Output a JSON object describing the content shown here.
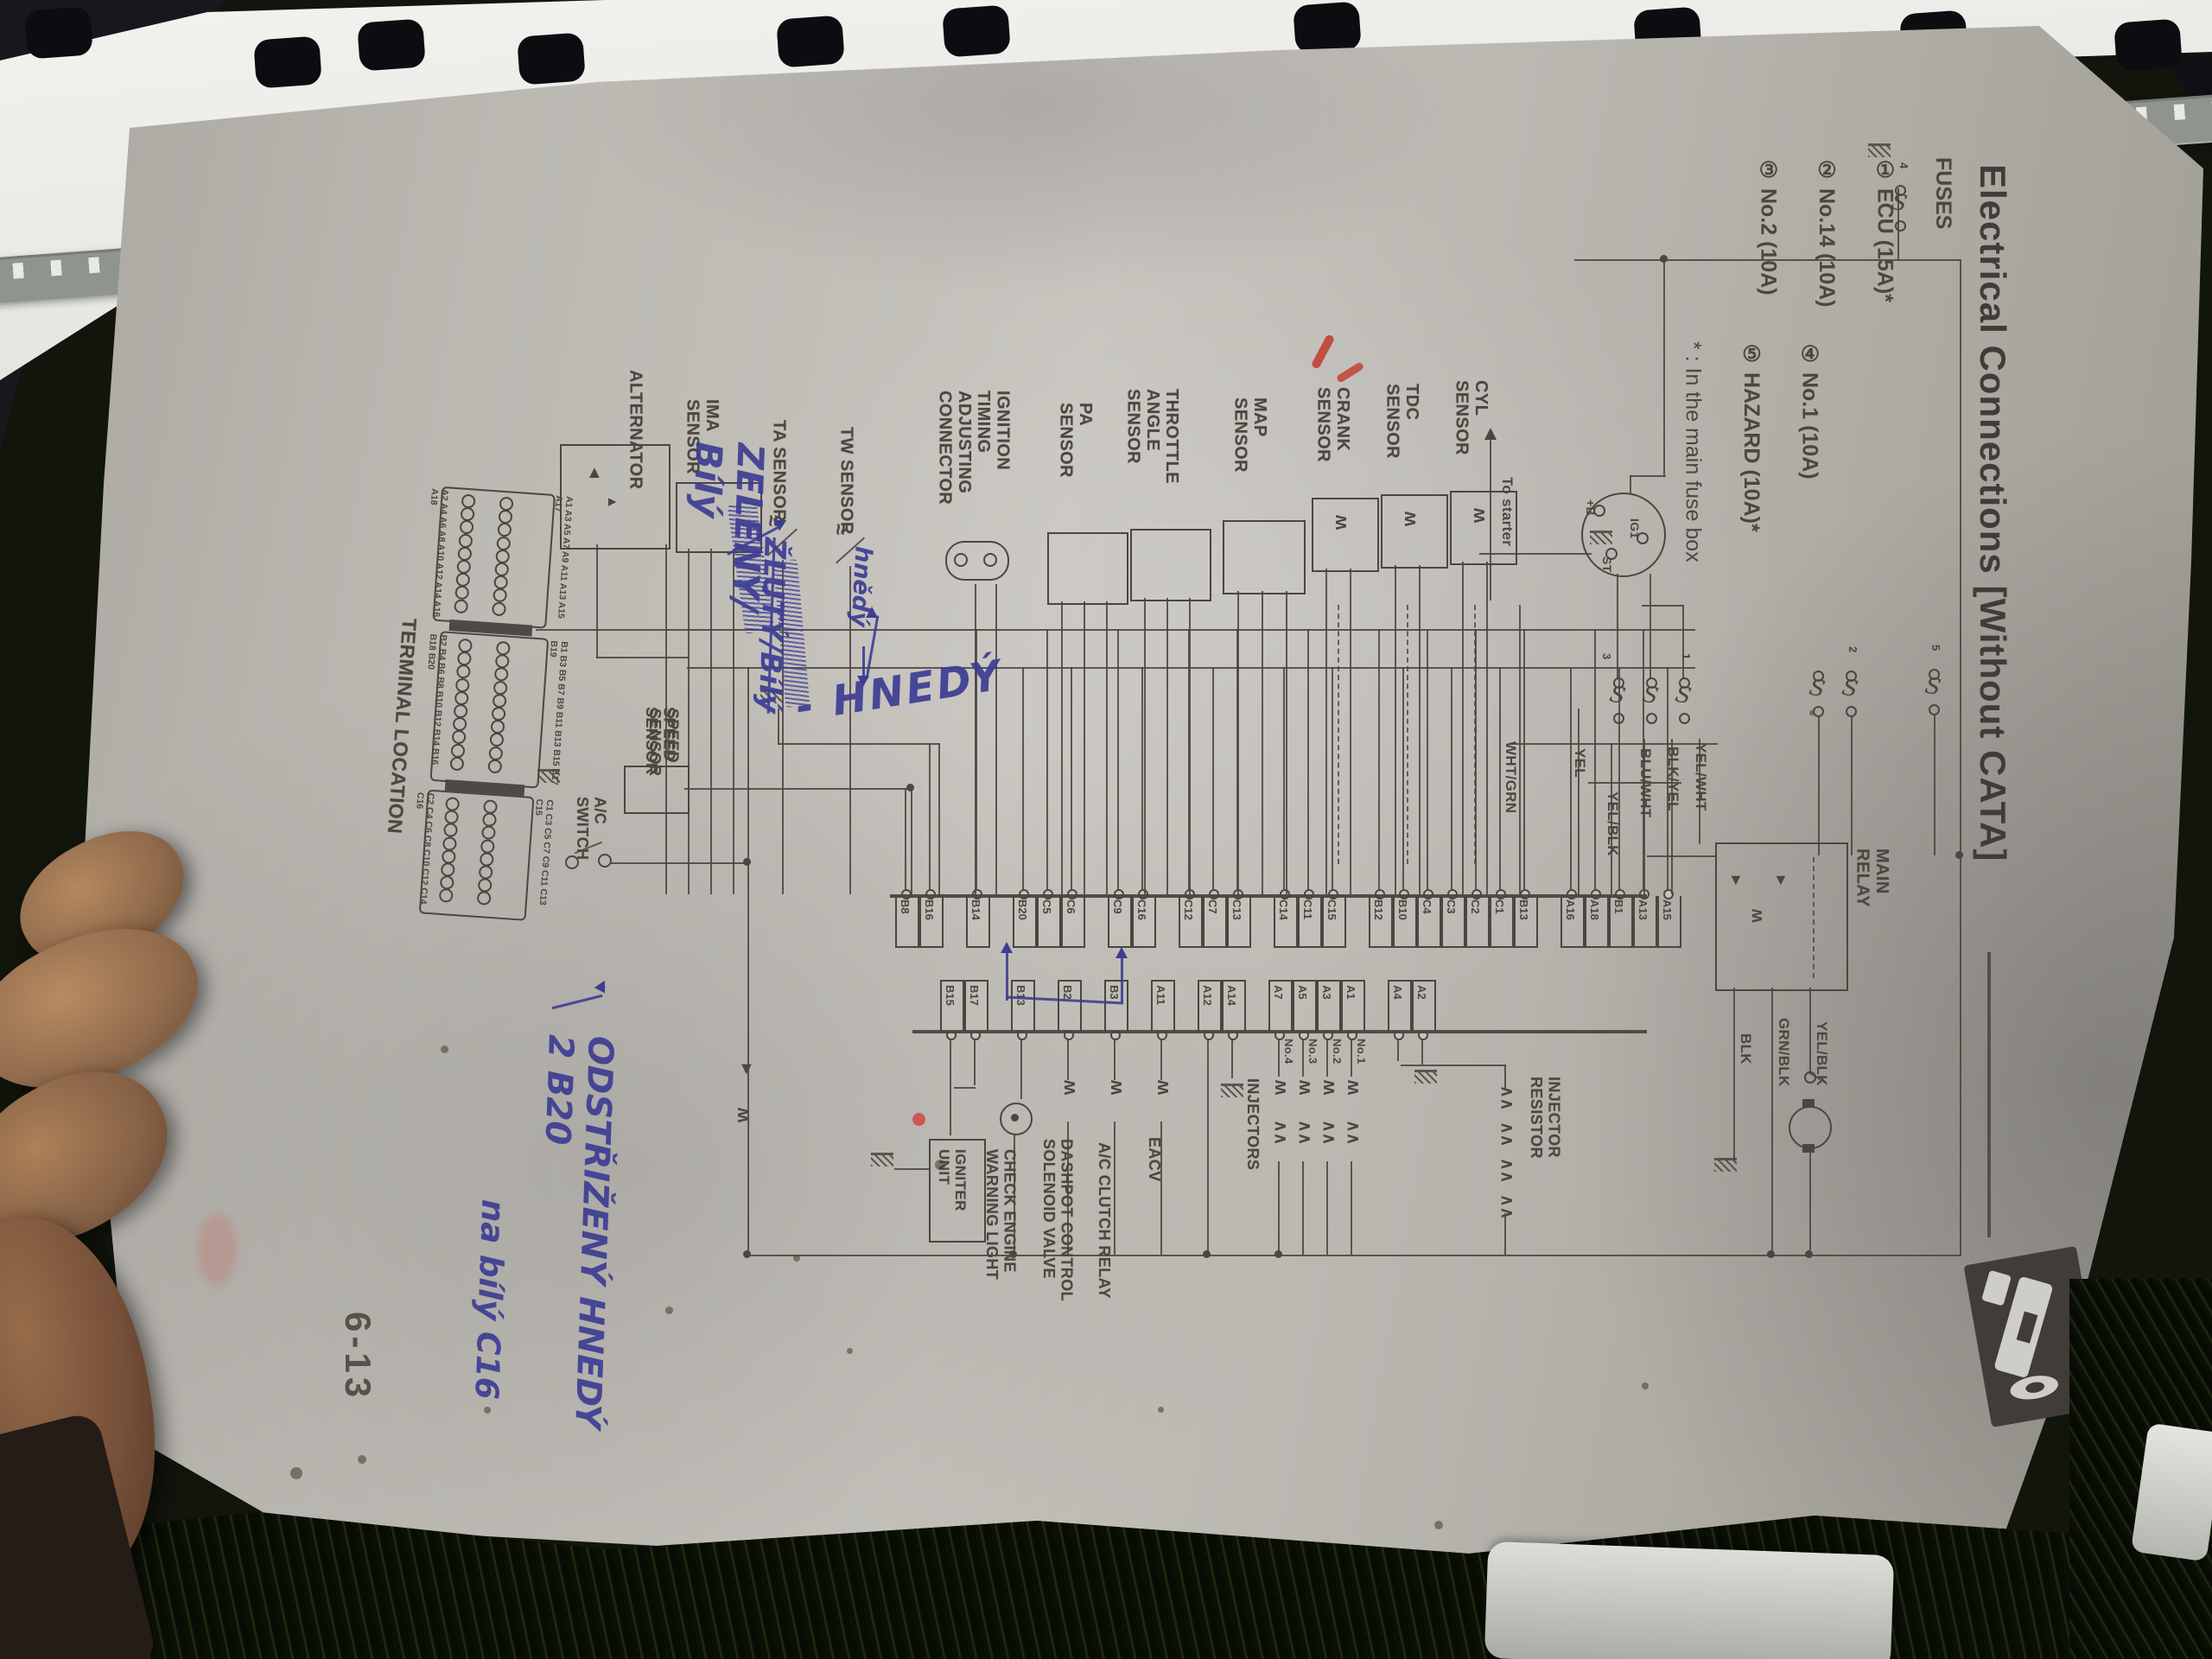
{
  "header": {
    "title": "Electrical Connections [Without CATA]"
  },
  "page_number": "6-13",
  "fuses": {
    "heading": "FUSES",
    "items": [
      "① ECU (15A)*",
      "② No.14 (10A)",
      "③ No.2 (10A)",
      "④ No.1 (10A)",
      "⑤ HAZARD (10A)*"
    ],
    "note": "* : In the main fuse box",
    "marks": {
      "f1": "1",
      "f2": "2",
      "f3": "3",
      "f4": "4",
      "f5": "5"
    }
  },
  "sensors": [
    "ALTERNATOR",
    "IMA\nSENSOR",
    "TA SENSOR",
    "TW SENSOR",
    "IGNITION\nTIMING\nADJUSTING\nCONNECTOR",
    "PA\nSENSOR",
    "THROTTLE\nANGLE\nSENSOR",
    "MAP\nSENSOR",
    "CRANK\nSENSOR",
    "TDC\nSENSOR",
    "CYL\nSENSOR"
  ],
  "ignition": {
    "to_starter": "To starter",
    "terminals": [
      "+B",
      "IG1",
      "ST"
    ]
  },
  "wire_labels": {
    "wht_grn": "WHT/GRN",
    "yel": "YEL",
    "yel_blk": "YEL/BLK",
    "blu_wht": "BLU/WHT",
    "blk_yel": "BLK/YEL",
    "yel_wht": "YEL/WHT",
    "blk": "BLK",
    "grn_blk": "GRN/BLK",
    "yel_blk2": "YEL/BLK"
  },
  "main_relay": "MAIN\nRELAY",
  "ecu": {
    "row1_groups": [
      [
        "B8",
        "B16"
      ],
      [
        "B14"
      ],
      [
        "B20",
        "C5",
        "C6"
      ],
      [
        "C9",
        "C16"
      ],
      [
        "C12",
        "C7",
        "C13"
      ],
      [
        "C14",
        "C11",
        "C15"
      ],
      [
        "B12",
        "B10",
        "C4",
        "C3",
        "C2",
        "C1",
        "B13"
      ],
      [
        "A16",
        "A18",
        "B1",
        "A13",
        "A15"
      ]
    ],
    "row2_groups": [
      [
        "B15",
        "B17"
      ],
      [
        "B13"
      ],
      [
        "B2"
      ],
      [
        "B3"
      ],
      [
        "A11"
      ],
      [
        "A12",
        "A14"
      ],
      [
        "A7",
        "A5",
        "A3",
        "A1"
      ],
      [
        "A4",
        "A2"
      ]
    ]
  },
  "components": {
    "speed_sensor": "SPEED\nSENSOR",
    "ac_switch": "A/C\nSWITCH",
    "igniter": "IGNITER\nUNIT",
    "check_engine": "CHECK ENGINE\nWARNING LIGHT",
    "dashpot": "DASHPOT CONTROL\nSOLENOID VALVE",
    "ac_clutch": "A/C CLUTCH RELAY",
    "eacv": "EACV",
    "injectors": "INJECTORS",
    "injector_nos": [
      "No.4",
      "No.3",
      "No.2",
      "No.1"
    ],
    "injector_resistor": "INJECTOR\nRESISTOR"
  },
  "terminal_location": {
    "title": "TERMINAL LOCATION",
    "blocks": [
      {
        "odd": "A1 A3 A5 A7 A9 A11 A13 A15 A17",
        "even": "A2 A4 A6 A8 A10 A12 A14 A16 A18",
        "holes": 9
      },
      {
        "odd": "B1 B3 B5 B7 B9 B11 B13 B15 B17 B19",
        "even": "B2 B4 B6 B8 B10 B12 B14 B16 B18 B20",
        "holes": 10
      },
      {
        "odd": "C1 C3 C5 C7 C9 C11 C13 C15",
        "even": "C2 C4 C6 C8 C10 C12 C14 C16",
        "holes": 8
      }
    ]
  },
  "handwriting": {
    "zeleny": "ZELENÝ/\nBílý",
    "zluty": "ŽLUTÝ/Bílý",
    "hnedy_small": "hnědý",
    "hnedy_big": "- HNEDÝ",
    "odstrizeny": "ODSTŘIŽENÝ HNEDÝ 2 B20",
    "na_bily": "na bílý C16"
  },
  "colors": {
    "paper": "#b5b2ac",
    "ink": "#4b463f",
    "blue_ink": "#3d3d94",
    "red_mark": "#c0392b"
  }
}
